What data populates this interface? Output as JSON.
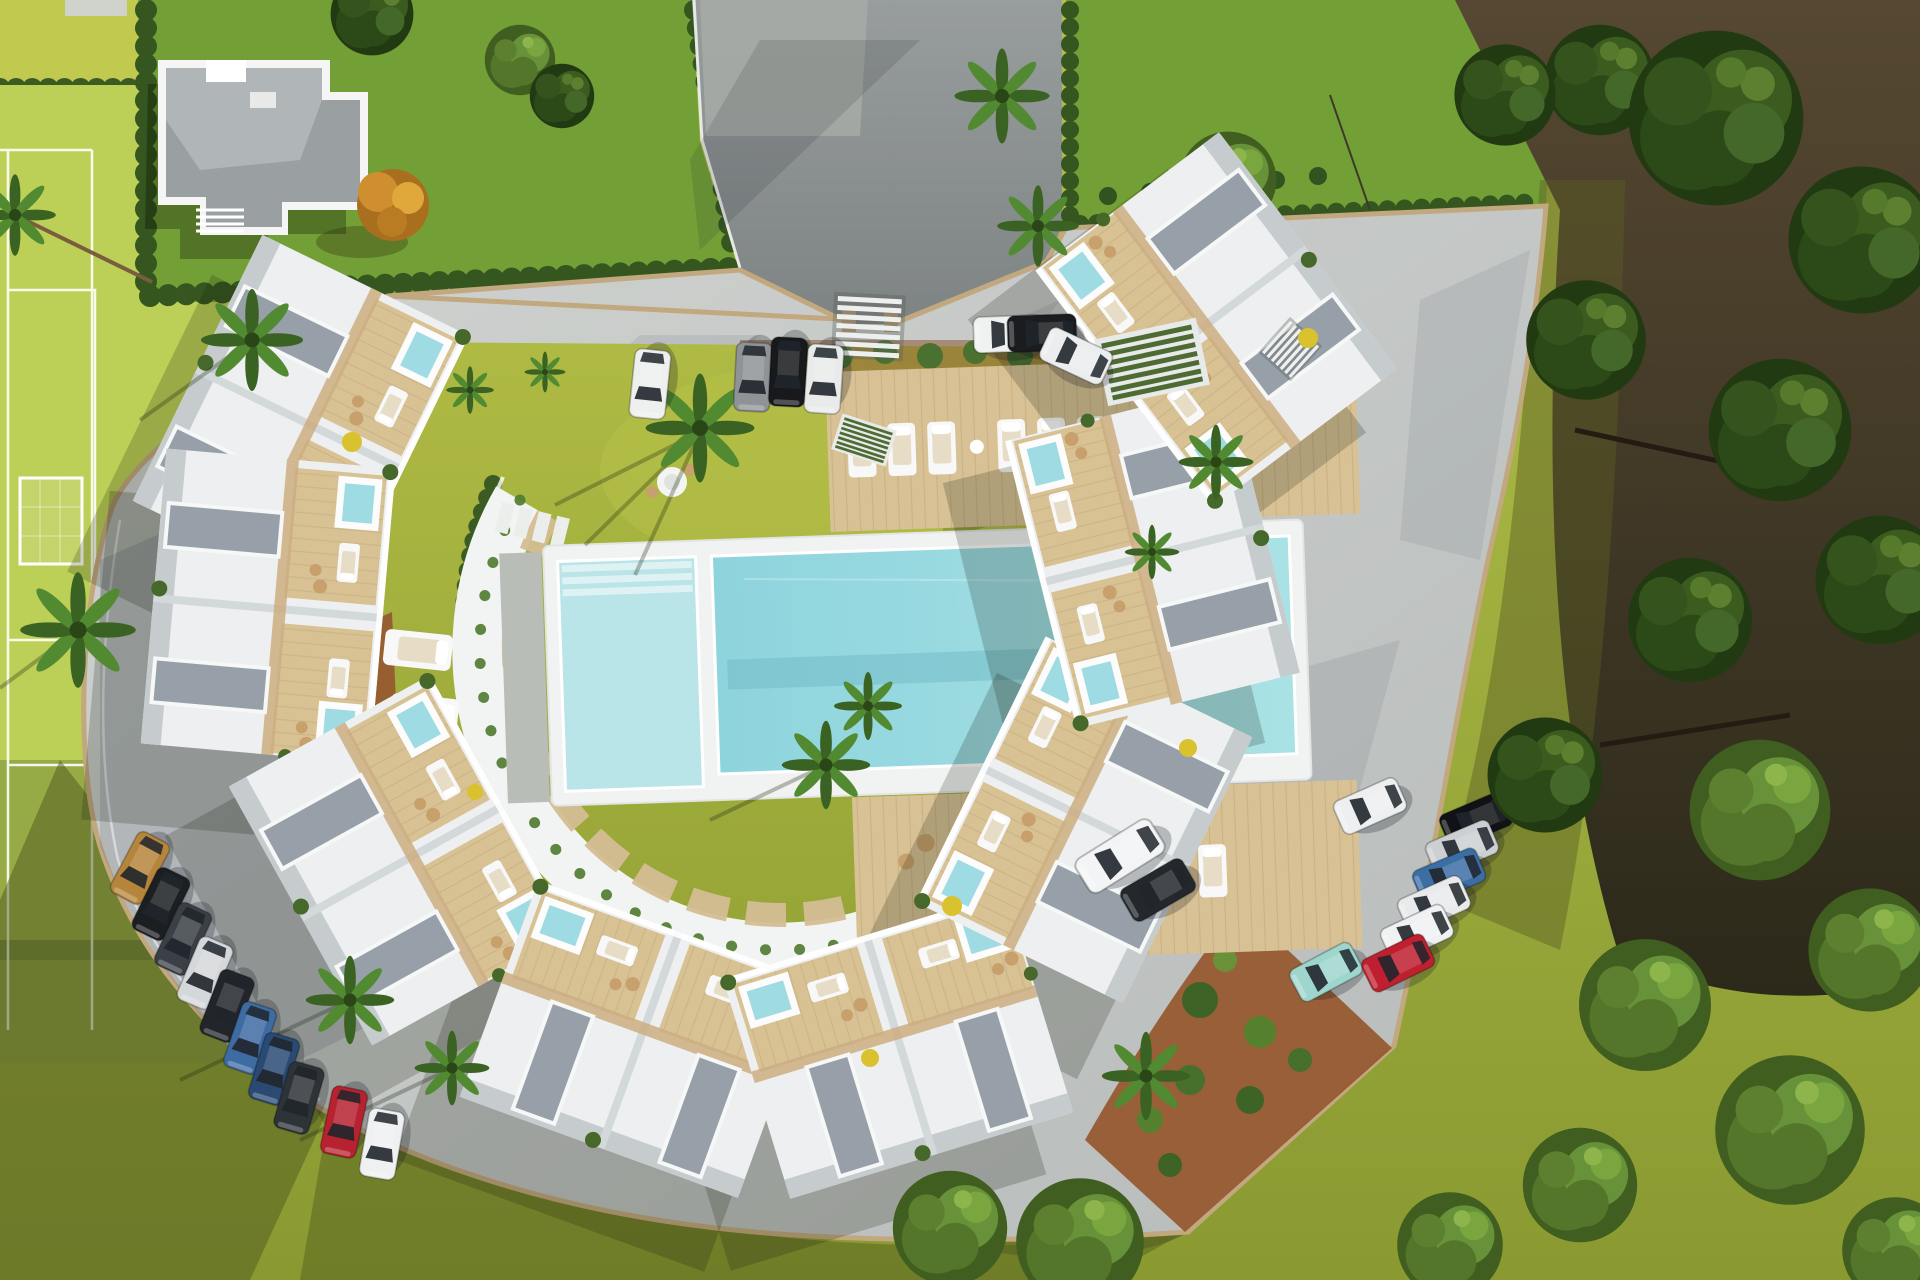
{
  "scene": {
    "title": "Aerial 3D render of a crescent-shaped residential complex with communal pool",
    "description": "Top-down architectural visualization: white flat-roof townhouses with timber roof terraces and plunge pools arranged in a horseshoe around a central lawn and swimming pool; sports field to the west, neighbouring villa parcel to the north, dense woodland to the east, perimeter roads with parked cars.",
    "time_of_day": "midday, sun from upper right casting shadows to lower left"
  },
  "palette": {
    "grass_base": "#a3b13c",
    "field_green": "#bccf57",
    "lawn_bright": "#73a036",
    "lawn_olive": "#a6b23e",
    "lawn_olive_light": "#aeb944",
    "lawn_shadow": "#4f5a1f",
    "hedge": "#3a5c22",
    "hedge_light": "#4e7a2e",
    "forest_ground": "#3d3522",
    "tree_dark": "#2b4617",
    "tree_light": "#6a9138",
    "palm_green": "#477a2b",
    "pavement": "#c6c9c6",
    "pavement_shade": "#5a6576",
    "asphalt": "#8b9092",
    "asphalt_apron": "#a9aca7",
    "boundary_wall": "#c2a87e",
    "white_structure": "#f2f4f3",
    "white_roof": "#edeff0",
    "deck_wood": "#d8c295",
    "gravel_roof": "#97a0a9",
    "pool_water": "#86ced9",
    "pool_water_light": "#b9e4e8",
    "plunge_pool": "#9fdbe3",
    "mulch": "#96572e",
    "lounger_white": "#f6f7f6",
    "wicker_tan": "#c7a06b",
    "accent_yellow": "#d9c22e",
    "orange_tree": "#cf8f2e",
    "line_white": "#ffffff"
  },
  "site": {
    "sports_field": {
      "line_color": "#ffffff",
      "features": [
        "sideline",
        "penalty box",
        "goal with net"
      ]
    },
    "neighbor_parcel": {
      "house": "white villa with grey flat roof",
      "hedge_border": true,
      "autumn_tree": 1
    },
    "entrance": {
      "gate_pillars": 2,
      "driveway": "asphalt",
      "visitor_parking_spots": 4
    },
    "buildings": {
      "clusters": 8,
      "units_per_cluster": 2,
      "style": "white flat-roof townhouses, timber roof terraces, gravel roofs, rooftop plunge pools, glass railings"
    },
    "amenities": {
      "main_pool": 1,
      "kids_pool": 1,
      "deck_loungers_north": 8,
      "deck_loungers_south": 5,
      "lawn_loungers": 5,
      "round_tables": 2,
      "pergolas": 2,
      "stair_flights": 2,
      "stepping_stone_paths": 2,
      "round_pads": 2
    }
  },
  "vehicles": {
    "top_row": [
      {
        "type": "car",
        "color": "#eef0f0"
      },
      {
        "type": "car",
        "color": "#8f9396"
      },
      {
        "type": "car",
        "color": "#17191c"
      },
      {
        "type": "car",
        "color": "#e9ebeb"
      }
    ],
    "right_entry": [
      {
        "type": "car",
        "color": "#f0f1f1"
      },
      {
        "type": "car",
        "color": "#1a1c1f"
      },
      {
        "type": "car",
        "color": "#ecedee"
      }
    ],
    "left_row": [
      {
        "type": "car",
        "color": "#b5853c"
      },
      {
        "type": "car",
        "color": "#1c1f22"
      },
      {
        "type": "car",
        "color": "#3a4046"
      },
      {
        "type": "car",
        "color": "#d5d8da"
      },
      {
        "type": "car",
        "color": "#22262b"
      },
      {
        "type": "car",
        "color": "#3f6ba3"
      },
      {
        "type": "car",
        "color": "#2a4a74"
      },
      {
        "type": "car",
        "color": "#2e3338"
      },
      {
        "type": "car",
        "color": "#b6222f"
      },
      {
        "type": "car",
        "color": "#eef0f1"
      }
    ],
    "bottom_right": [
      {
        "type": "car",
        "color": "#edeff0"
      },
      {
        "type": "van",
        "color": "#f3f4f5"
      },
      {
        "type": "suv",
        "color": "#24282d"
      },
      {
        "type": "car",
        "color": "#9ed6cd"
      },
      {
        "type": "car",
        "color": "#101215"
      },
      {
        "type": "car",
        "color": "#ccd0d3"
      },
      {
        "type": "car",
        "color": "#3c6ea6"
      },
      {
        "type": "car",
        "color": "#e8eaec"
      },
      {
        "type": "car",
        "color": "#f0f1f2"
      },
      {
        "type": "car",
        "color": "#bf1f2e"
      }
    ]
  },
  "vegetation": {
    "palm_trees": 15,
    "forest_trees": 18,
    "hedge_rows": 7,
    "mulch_beds": 4,
    "orange_trees": 1,
    "yellow_accent_plants": 6
  }
}
